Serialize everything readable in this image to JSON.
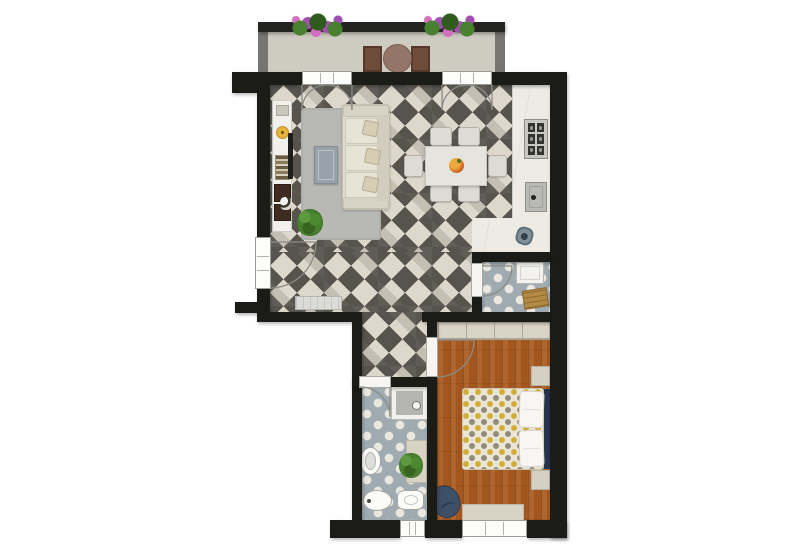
{
  "scene": {
    "type": "apartment-floor-plan",
    "view": "top-down-2d-render",
    "text_visible": "none"
  },
  "palette": {
    "bg": "#ffffff",
    "wall": "#1b1b18",
    "railing": "#23231f",
    "post": "#77756f",
    "balconyFloor": "#cecbc1",
    "tileLight": "#ddd8cb",
    "tileDark": "#57544e",
    "tileMid": "rgba(125,120,111,0.26)",
    "mosaicBase": "#9fabb1",
    "mosaicDot": "#e9e7de",
    "wood": "#a3571f",
    "marble": "#edebe4",
    "frame": "#fcfcfa",
    "console": "#f1f0ec",
    "lamp": "#e6b43c",
    "tv": "#1d1d1b",
    "rug": "#b8b9b5",
    "steelBlue": "#99a1aa",
    "sofa": "#e0dccd",
    "cushion": "#e7e3d5",
    "tableTop": "#e6e4de",
    "chair": "#dddbd4",
    "stove": "#33332f",
    "appliance": "#f3f2ee",
    "basket": "#b28a46",
    "fixture": "#fbfbf9",
    "showerInner": "#b4b4b0",
    "wardrobe": "#d9d4c6",
    "duvet": "#eae6d5",
    "dotYellow": "#d2ac39",
    "dotGrey": "#8f8a77",
    "pillow": "#f7f6f2",
    "headboard": "#26334d",
    "navy": "#3e4f68",
    "bench": "#d8d3c5",
    "radiator": "#dbdbd8",
    "leaf": "#49802f",
    "leafDark": "#2f5c1e",
    "flower": "#a14fae",
    "flowerAlt": "#d36ec0",
    "bistro": "#937668",
    "arcStroke": "#8b8b86"
  },
  "rooms": [
    {
      "id": "balcony",
      "floor": "stone",
      "furniture": [
        "flower-box",
        "flower-box",
        "bistro-table",
        "bistro-chair",
        "bistro-chair"
      ]
    },
    {
      "id": "living-room",
      "floor": "diamond-checker-tile",
      "furniture": [
        "media-console",
        "decor",
        "table-lamp",
        "tv",
        "book-stack",
        "storage-box",
        "storage-box",
        "knick-knack",
        "rug",
        "coffee-table",
        "three-seat-sofa",
        "throw-pillow",
        "throw-pillow",
        "throw-pillow",
        "potted-plant",
        "radiator"
      ]
    },
    {
      "id": "kitchen-dining",
      "floor": "diamond-checker-tile",
      "furniture": [
        "kitchen-counter",
        "cooktop",
        "sink",
        "trash-bin",
        "dining-table",
        "fruit-bowl",
        "dining-chair",
        "dining-chair",
        "dining-chair",
        "dining-chair",
        "dining-chair",
        "dining-chair"
      ]
    },
    {
      "id": "laundry-room",
      "floor": "blue-mosaic-tile",
      "furniture": [
        "washing-machine",
        "laundry-basket"
      ]
    },
    {
      "id": "hallway",
      "floor": "diamond-checker-tile",
      "furniture": []
    },
    {
      "id": "bathroom",
      "floor": "blue-mosaic-tile",
      "furniture": [
        "shower",
        "pedestal-sink",
        "shelf-bench",
        "potted-plant",
        "toilet",
        "bidet"
      ]
    },
    {
      "id": "bedroom",
      "floor": "hardwood",
      "furniture": [
        "wardrobe",
        "double-bed",
        "pillow",
        "pillow",
        "headboard",
        "nightstand",
        "nightstand",
        "beanbag-chair",
        "bench",
        "area-dark-blue"
      ]
    }
  ],
  "openings": {
    "balcony_french_doors": 2,
    "french_window_left": 1,
    "interior_doors": [
      "laundry",
      "bedroom",
      "bathroom"
    ],
    "windows": [
      "living-left-wall",
      "bathroom-bottom",
      "bedroom-bottom"
    ]
  }
}
